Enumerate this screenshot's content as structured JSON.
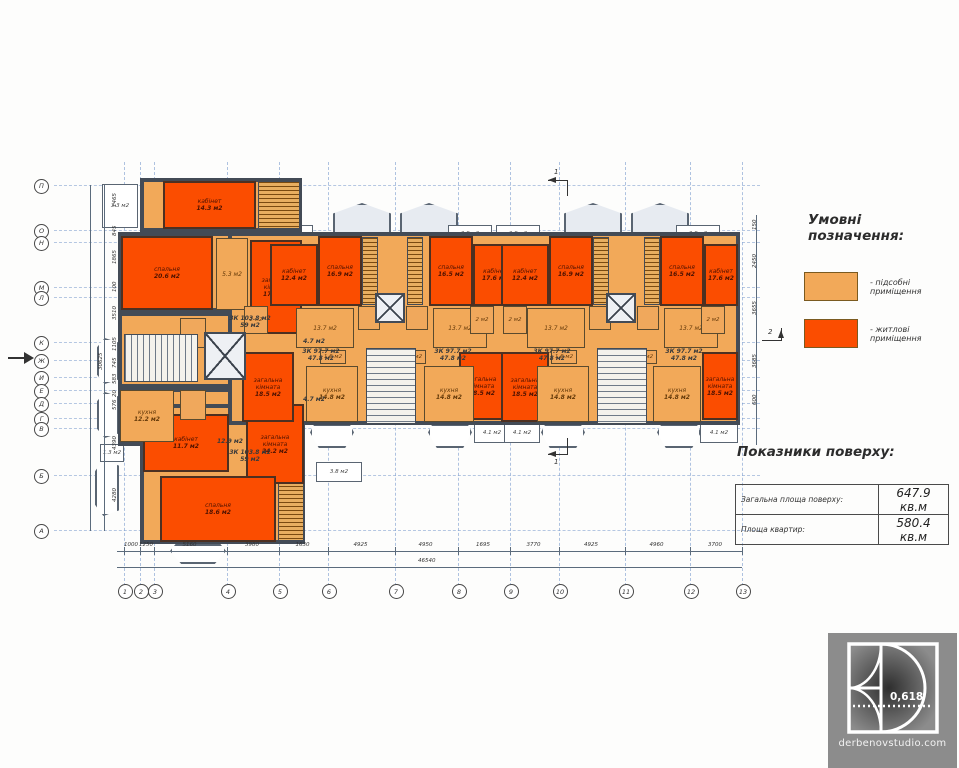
{
  "legend": {
    "title": "Умовні позначення:",
    "items": [
      {
        "label": "- підсобні приміщення",
        "color": "#F2A959"
      },
      {
        "label": "- житлові приміщення",
        "color": "#FB4D00"
      }
    ]
  },
  "indicators": {
    "title": "Показники поверху:",
    "rows": [
      {
        "label": "Загальна площа поверху:",
        "value": "647.9 кв.м"
      },
      {
        "label": "Площа квартир:",
        "value": "580.4 кв.м"
      }
    ]
  },
  "logo": {
    "ratio": "0,618",
    "site": "derbenovstudio.com"
  },
  "plan": {
    "axes_bottom": [
      {
        "label": "1",
        "x": 124
      },
      {
        "label": "2",
        "x": 140
      },
      {
        "label": "3",
        "x": 154
      },
      {
        "label": "4",
        "x": 227
      },
      {
        "label": "5",
        "x": 279
      },
      {
        "label": "6",
        "x": 328
      },
      {
        "label": "7",
        "x": 395
      },
      {
        "label": "8",
        "x": 458
      },
      {
        "label": "9",
        "x": 510
      },
      {
        "label": "10",
        "x": 559
      },
      {
        "label": "11",
        "x": 625
      },
      {
        "label": "12",
        "x": 690
      },
      {
        "label": "13",
        "x": 742
      }
    ],
    "axes_left": [
      {
        "label": "П",
        "y": 185
      },
      {
        "label": "О",
        "y": 230
      },
      {
        "label": "Н",
        "y": 242
      },
      {
        "label": "М",
        "y": 287
      },
      {
        "label": "Л",
        "y": 297
      },
      {
        "label": "К",
        "y": 342
      },
      {
        "label": "Ж",
        "y": 360
      },
      {
        "label": "И",
        "y": 377
      },
      {
        "label": "Е",
        "y": 390
      },
      {
        "label": "Д",
        "y": 403
      },
      {
        "label": "Г",
        "y": 418
      },
      {
        "label": "В",
        "y": 428
      },
      {
        "label": "Б",
        "y": 475
      },
      {
        "label": "А",
        "y": 530
      }
    ],
    "dims_bottom": {
      "segments": [
        "1000",
        "1250",
        "5160",
        "3980",
        "1630",
        "4925",
        "4950",
        "1695",
        "3770",
        "4925",
        "4960",
        "3700"
      ],
      "total": "46540"
    },
    "dims_left": [
      {
        "v": "1465",
        "y": 207
      },
      {
        "v": "845",
        "y": 236
      },
      {
        "v": "1865",
        "y": 264
      },
      {
        "v": "100",
        "y": 292
      },
      {
        "v": "3510",
        "y": 320
      },
      {
        "v": "1105",
        "y": 351
      },
      {
        "v": "745",
        "y": 368
      },
      {
        "v": "583",
        "y": 384
      },
      {
        "v": "20",
        "y": 397
      },
      {
        "v": "576",
        "y": 410
      },
      {
        "v": "4390",
        "y": 450
      },
      {
        "v": "4280",
        "y": 502
      }
    ],
    "dims_left_total": "30625",
    "dims_right": [
      {
        "v": "150",
        "y": 230
      },
      {
        "v": "2450",
        "y": 268
      },
      {
        "v": "3655",
        "y": 315
      },
      {
        "v": "3685",
        "y": 368
      },
      {
        "v": "600",
        "y": 405
      }
    ],
    "marks": [
      {
        "label": "1",
        "x": 548,
        "y": 168,
        "dir": "top"
      },
      {
        "label": "1",
        "x": 548,
        "y": 442,
        "dir": "bottom"
      },
      {
        "label": "2",
        "x": 762,
        "y": 328,
        "dir": "right"
      }
    ],
    "elements": [
      {
        "kind": "lodge",
        "x": 333,
        "y": 203,
        "w": 58,
        "h": 31
      },
      {
        "kind": "lodge",
        "x": 400,
        "y": 203,
        "w": 58,
        "h": 31
      },
      {
        "kind": "lodge",
        "x": 564,
        "y": 203,
        "w": 58,
        "h": 31
      },
      {
        "kind": "lodge",
        "x": 631,
        "y": 203,
        "w": 58,
        "h": 31
      },
      {
        "kind": "bay",
        "x": 310,
        "y": 424,
        "w": 44,
        "h": 24
      },
      {
        "kind": "bay",
        "x": 428,
        "y": 424,
        "w": 44,
        "h": 24
      },
      {
        "kind": "bay",
        "x": 541,
        "y": 424,
        "w": 44,
        "h": 24
      },
      {
        "kind": "bay",
        "x": 657,
        "y": 424,
        "w": 44,
        "h": 24
      },
      {
        "kind": "bay",
        "x": 170,
        "y": 544,
        "w": 56,
        "h": 20
      },
      {
        "kind": "bayl",
        "x": 97,
        "y": 338,
        "w": 22,
        "h": 46
      },
      {
        "kind": "bayl",
        "x": 97,
        "y": 392,
        "w": 22,
        "h": 46
      },
      {
        "kind": "bayl",
        "x": 95,
        "y": 460,
        "w": 24,
        "h": 56
      },
      {
        "kind": "terrace",
        "x": 221,
        "y": 225,
        "w": 44,
        "h": 19,
        "l1": "3.8 м2"
      },
      {
        "kind": "terrace",
        "x": 269,
        "y": 225,
        "w": 44,
        "h": 19,
        "l1": "3.8 м2"
      },
      {
        "kind": "terrace",
        "x": 448,
        "y": 225,
        "w": 44,
        "h": 19,
        "l1": "3.8 м2"
      },
      {
        "kind": "terrace",
        "x": 496,
        "y": 225,
        "w": 44,
        "h": 19,
        "l1": "3.8 м2"
      },
      {
        "kind": "terrace",
        "x": 676,
        "y": 225,
        "w": 44,
        "h": 19,
        "l1": "3.8 м2"
      },
      {
        "kind": "terrace",
        "x": 246,
        "y": 424,
        "w": 40,
        "h": 19,
        "l1": "4.1 м2"
      },
      {
        "kind": "terrace",
        "x": 474,
        "y": 424,
        "w": 36,
        "h": 19,
        "l1": "4.1 м2"
      },
      {
        "kind": "terrace",
        "x": 504,
        "y": 424,
        "w": 36,
        "h": 19,
        "l1": "4.1 м2"
      },
      {
        "kind": "terrace",
        "x": 700,
        "y": 424,
        "w": 38,
        "h": 19,
        "l1": "4.1 м2"
      },
      {
        "kind": "terrace",
        "x": 316,
        "y": 462,
        "w": 46,
        "h": 20,
        "l1": "3.8 м2"
      },
      {
        "kind": "terrace",
        "x": 100,
        "y": 444,
        "w": 24,
        "h": 18,
        "l1": "1.3 м2"
      },
      {
        "kind": "terrace",
        "x": 102,
        "y": 184,
        "w": 36,
        "h": 44,
        "l1": "3.3 м2"
      },
      {
        "kind": "outline",
        "x": 140,
        "y": 178,
        "w": 162,
        "h": 54
      },
      {
        "kind": "outline",
        "x": 118,
        "y": 232,
        "w": 184,
        "h": 80
      },
      {
        "kind": "outline",
        "x": 118,
        "y": 312,
        "w": 184,
        "h": 76
      },
      {
        "kind": "outline",
        "x": 118,
        "y": 388,
        "w": 184,
        "h": 58
      },
      {
        "kind": "outline",
        "x": 140,
        "y": 404,
        "w": 165,
        "h": 140
      },
      {
        "kind": "outline",
        "x": 228,
        "y": 232,
        "w": 512,
        "h": 193
      },
      {
        "kind": "shaft",
        "x": 258,
        "y": 181,
        "w": 42,
        "h": 48
      },
      {
        "kind": "shaft",
        "x": 278,
        "y": 477,
        "w": 26,
        "h": 64
      },
      {
        "kind": "shaft",
        "x": 362,
        "y": 237,
        "w": 16,
        "h": 68
      },
      {
        "kind": "shaft",
        "x": 407,
        "y": 237,
        "w": 16,
        "h": 68
      },
      {
        "kind": "shaft",
        "x": 593,
        "y": 237,
        "w": 16,
        "h": 68
      },
      {
        "kind": "shaft",
        "x": 644,
        "y": 237,
        "w": 16,
        "h": 68
      },
      {
        "kind": "living",
        "x": 163,
        "y": 181,
        "w": 93,
        "h": 48,
        "l1": "кабінет",
        "l2": "14.3 м2"
      },
      {
        "kind": "living",
        "x": 121,
        "y": 236,
        "w": 92,
        "h": 74,
        "l1": "спальня",
        "l2": "20.6 м2"
      },
      {
        "kind": "living",
        "x": 250,
        "y": 240,
        "w": 52,
        "h": 94,
        "l1": "загальна кімната",
        "l2": "17.7 м2"
      },
      {
        "kind": "living",
        "x": 143,
        "y": 414,
        "w": 86,
        "h": 58,
        "l1": "кабінет",
        "l2": "11.7 м2"
      },
      {
        "kind": "living",
        "x": 246,
        "y": 404,
        "w": 58,
        "h": 80,
        "l1": "загальна кімната",
        "l2": "24.2 м2"
      },
      {
        "kind": "living",
        "x": 160,
        "y": 476,
        "w": 116,
        "h": 66,
        "l1": "спальня",
        "l2": "18.6 м2"
      },
      {
        "kind": "living",
        "x": 318,
        "y": 236,
        "w": 44,
        "h": 70,
        "l1": "спальня",
        "l2": "16.9 м2"
      },
      {
        "kind": "living",
        "x": 429,
        "y": 236,
        "w": 44,
        "h": 70,
        "l1": "спальня",
        "l2": "16.5 м2"
      },
      {
        "kind": "living",
        "x": 270,
        "y": 244,
        "w": 48,
        "h": 62,
        "l1": "кабінет",
        "l2": "12.4 м2"
      },
      {
        "kind": "living",
        "x": 473,
        "y": 244,
        "w": 44,
        "h": 62,
        "l1": "кабінет",
        "l2": "17.6 м2"
      },
      {
        "kind": "living",
        "x": 242,
        "y": 352,
        "w": 52,
        "h": 70,
        "l1": "загальна кімната",
        "l2": "18.5 м2"
      },
      {
        "kind": "living",
        "x": 459,
        "y": 352,
        "w": 46,
        "h": 68,
        "l1": "загальна кімната",
        "l2": "18.5 м2"
      },
      {
        "kind": "living",
        "x": 549,
        "y": 236,
        "w": 44,
        "h": 70,
        "l1": "спальня",
        "l2": "16.9 м2"
      },
      {
        "kind": "living",
        "x": 660,
        "y": 236,
        "w": 44,
        "h": 70,
        "l1": "спальня",
        "l2": "16.5 м2"
      },
      {
        "kind": "living",
        "x": 501,
        "y": 244,
        "w": 48,
        "h": 62,
        "l1": "кабінет",
        "l2": "12.4 м2"
      },
      {
        "kind": "living",
        "x": 704,
        "y": 244,
        "w": 34,
        "h": 62,
        "l1": "кабінет",
        "l2": "17.6 м2"
      },
      {
        "kind": "living",
        "x": 501,
        "y": 352,
        "w": 48,
        "h": 70,
        "l1": "загальна кімната",
        "l2": "18.5 м2"
      },
      {
        "kind": "living",
        "x": 702,
        "y": 352,
        "w": 36,
        "h": 68,
        "l1": "загальна кімната",
        "l2": "18.5 м2"
      },
      {
        "kind": "utility",
        "x": 216,
        "y": 238,
        "w": 32,
        "h": 72,
        "l1": "5.3 м2"
      },
      {
        "kind": "utility",
        "x": 120,
        "y": 390,
        "w": 54,
        "h": 52,
        "l1": "кухня",
        "l2": "12.2 м2"
      },
      {
        "kind": "utility",
        "x": 296,
        "y": 308,
        "w": 58,
        "h": 40,
        "l1": "13.7 м2"
      },
      {
        "kind": "utility",
        "x": 433,
        "y": 308,
        "w": 54,
        "h": 40,
        "l1": "13.7 м2"
      },
      {
        "kind": "utility",
        "x": 527,
        "y": 308,
        "w": 58,
        "h": 40,
        "l1": "13.7 м2"
      },
      {
        "kind": "utility",
        "x": 664,
        "y": 308,
        "w": 54,
        "h": 40,
        "l1": "13.7 м2"
      },
      {
        "kind": "utility",
        "x": 306,
        "y": 366,
        "w": 52,
        "h": 56,
        "l1": "кухня",
        "l2": "14.8 м2"
      },
      {
        "kind": "utility",
        "x": 424,
        "y": 366,
        "w": 50,
        "h": 56,
        "l1": "кухня",
        "l2": "14.8 м2"
      },
      {
        "kind": "utility",
        "x": 537,
        "y": 366,
        "w": 52,
        "h": 56,
        "l1": "кухня",
        "l2": "14.8 м2"
      },
      {
        "kind": "utility",
        "x": 653,
        "y": 366,
        "w": 48,
        "h": 56,
        "l1": "кухня",
        "l2": "14.8 м2"
      },
      {
        "kind": "small",
        "x": 320,
        "y": 350,
        "w": 26,
        "h": 14,
        "l1": "1.6 м2"
      },
      {
        "kind": "small",
        "x": 400,
        "y": 350,
        "w": 26,
        "h": 14,
        "l1": "1.6 м2"
      },
      {
        "kind": "small",
        "x": 551,
        "y": 350,
        "w": 26,
        "h": 14,
        "l1": "1.6 м2"
      },
      {
        "kind": "small",
        "x": 631,
        "y": 350,
        "w": 26,
        "h": 14,
        "l1": "1.6 м2"
      },
      {
        "kind": "small",
        "x": 358,
        "y": 306,
        "w": 22,
        "h": 24
      },
      {
        "kind": "small",
        "x": 406,
        "y": 306,
        "w": 22,
        "h": 24
      },
      {
        "kind": "small",
        "x": 589,
        "y": 306,
        "w": 22,
        "h": 24
      },
      {
        "kind": "small",
        "x": 637,
        "y": 306,
        "w": 22,
        "h": 24
      },
      {
        "kind": "small",
        "x": 244,
        "y": 306,
        "w": 24,
        "h": 28,
        "l1": "2 м2"
      },
      {
        "kind": "small",
        "x": 470,
        "y": 306,
        "w": 24,
        "h": 28,
        "l1": "2 м2"
      },
      {
        "kind": "small",
        "x": 503,
        "y": 306,
        "w": 24,
        "h": 28,
        "l1": "2 м2"
      },
      {
        "kind": "small",
        "x": 701,
        "y": 306,
        "w": 24,
        "h": 28,
        "l1": "2 м2"
      },
      {
        "kind": "small",
        "x": 180,
        "y": 318,
        "w": 26,
        "h": 30
      },
      {
        "kind": "small",
        "x": 180,
        "y": 390,
        "w": 26,
        "h": 30
      },
      {
        "kind": "stairsv",
        "x": 124,
        "y": 334,
        "w": 74,
        "h": 48
      },
      {
        "kind": "stairs",
        "x": 366,
        "y": 348,
        "w": 50,
        "h": 76
      },
      {
        "kind": "stairs",
        "x": 597,
        "y": 348,
        "w": 50,
        "h": 76
      },
      {
        "kind": "elevator",
        "x": 204,
        "y": 332,
        "w": 42,
        "h": 48
      },
      {
        "kind": "elevator",
        "x": 375,
        "y": 293,
        "w": 30,
        "h": 30
      },
      {
        "kind": "elevator",
        "x": 606,
        "y": 293,
        "w": 30,
        "h": 30
      },
      {
        "kind": "text",
        "x": 206,
        "y": 312,
        "w": 88,
        "h": 20,
        "l1": "3К 103.8 м2",
        "l2": "59 м2"
      },
      {
        "kind": "text",
        "x": 206,
        "y": 446,
        "w": 88,
        "h": 20,
        "l1": "3К 103.8 м2",
        "l2": "59 м2"
      },
      {
        "kind": "text",
        "x": 288,
        "y": 346,
        "w": 66,
        "h": 18,
        "l1": "3К 97.7 м2",
        "l2": "47.8 м2"
      },
      {
        "kind": "text",
        "x": 420,
        "y": 346,
        "w": 66,
        "h": 18,
        "l1": "3К 97.7 м2",
        "l2": "47.8 м2"
      },
      {
        "kind": "text",
        "x": 519,
        "y": 346,
        "w": 66,
        "h": 18,
        "l1": "3К 97.7 м2",
        "l2": "47.8 м2"
      },
      {
        "kind": "text",
        "x": 651,
        "y": 346,
        "w": 66,
        "h": 18,
        "l1": "3К 97.7 м2",
        "l2": "47.8 м2"
      },
      {
        "kind": "text",
        "x": 298,
        "y": 336,
        "w": 32,
        "h": 11,
        "l1": "4.7 м2"
      },
      {
        "kind": "text",
        "x": 298,
        "y": 394,
        "w": 32,
        "h": 11,
        "l1": "4.7 м2"
      },
      {
        "kind": "text",
        "x": 212,
        "y": 436,
        "w": 36,
        "h": 11,
        "l1": "12.9 м2"
      }
    ]
  }
}
